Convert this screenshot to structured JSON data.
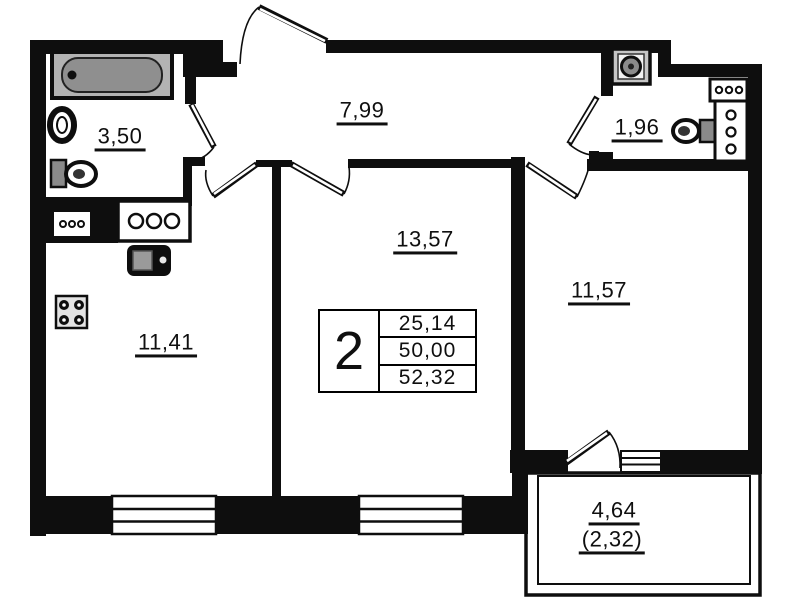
{
  "room_labels": {
    "bathroom": "3,50",
    "hallway": "7,99",
    "wc": "1,96",
    "living_room": "13,57",
    "bedroom": "11,57",
    "kitchen": "11,41",
    "balcony": "4,64",
    "balcony_reduced": "(2,32)"
  },
  "info_table": {
    "rooms_count": "2",
    "living_area": "25,14",
    "area_without_balcony": "50,00",
    "total_area": "52,32"
  },
  "colors": {
    "wall": "#0e0e0e",
    "background": "#ffffff",
    "bathtub_fill": "#8f8f8f",
    "fixture_gray": "#c6c6c6"
  }
}
